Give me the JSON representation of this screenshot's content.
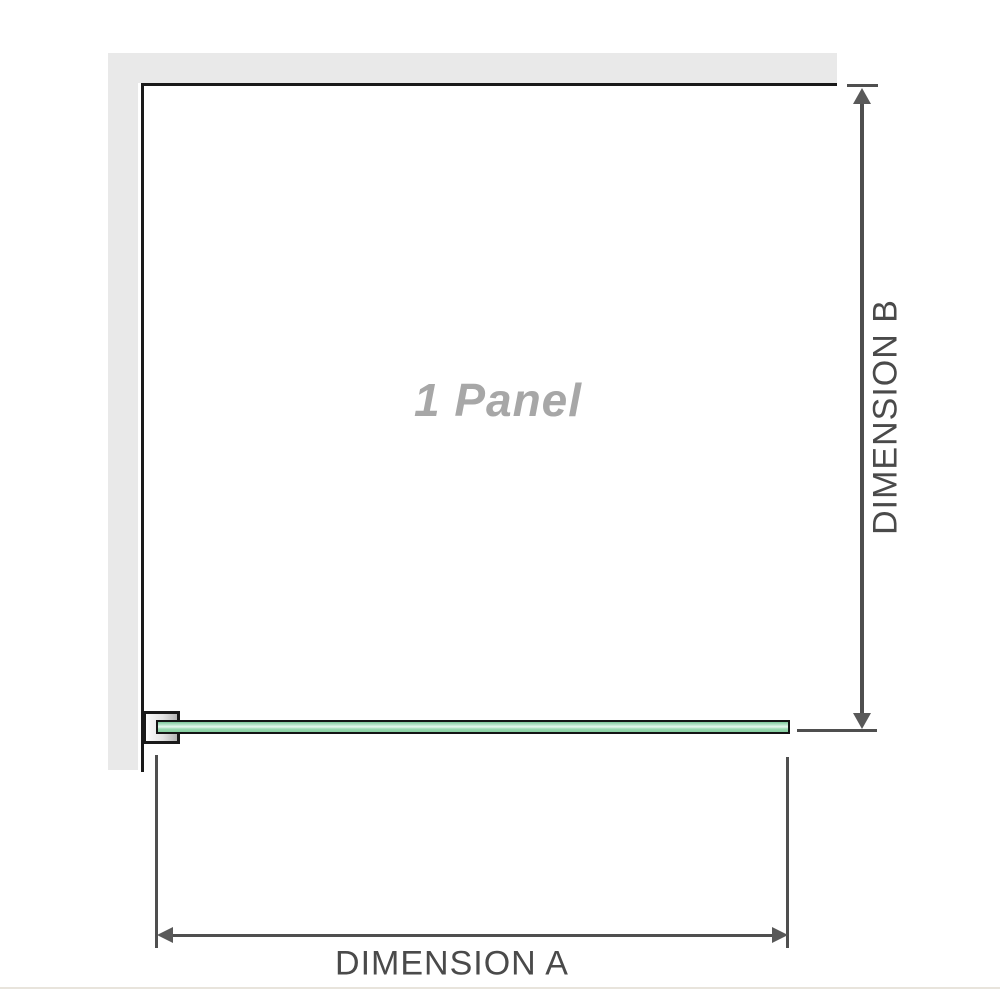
{
  "diagram": {
    "title_hint": "shower screen single panel dimension diagram",
    "panel_label": "1 Panel",
    "dimension_a_label": "DIMENSION A",
    "dimension_b_label": "DIMENSION B"
  },
  "colors": {
    "wall-gray": "#e9e9e9",
    "outline-black": "#1a1a1a",
    "dim-gray": "#4f4f4f",
    "label-dark": "#4a4a4a",
    "label-gray": "#a7a7a7",
    "glass-green": "#8fd3a5",
    "glass-highlight": "#e7f7ee",
    "divider-beige": "#e8e4dc"
  }
}
